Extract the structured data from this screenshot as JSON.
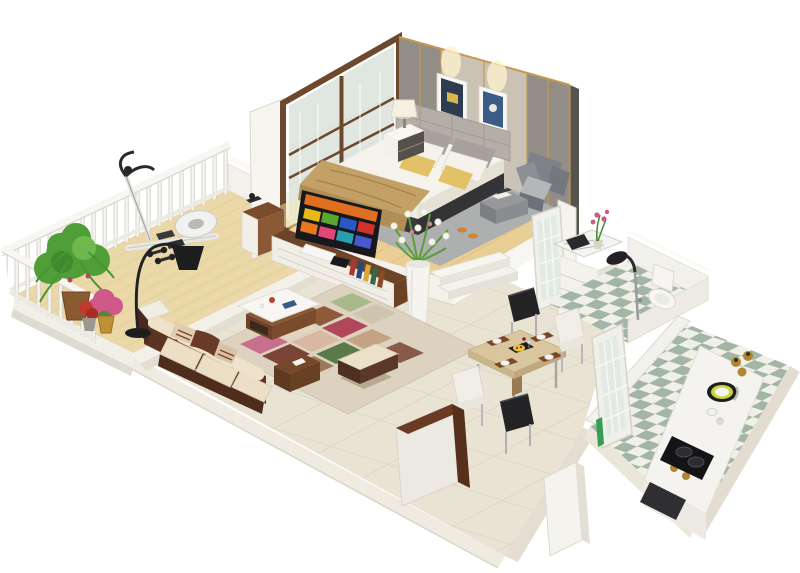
{
  "scene": {
    "description": "3D isometric cutaway render of a studio apartment floor plan",
    "rooms": [
      {
        "name": "balcony",
        "floor": "light wood planks",
        "items": [
          "white baluster railing",
          "hanging green plant",
          "pink and red potted flowers",
          "elliptical exercise trainer",
          "dumbbells"
        ]
      },
      {
        "name": "bedroom",
        "floor": "warm wood with gray rug",
        "items": [
          "double bed with white duvet",
          "tan throw blanket",
          "yellow accent pillows",
          "upholstered gray headboard",
          "two framed artworks",
          "wall spotlights",
          "sliding frosted-glass wardrobe doors",
          "white nightstand with table lamp",
          "gray armchair",
          "gray ottoman with books",
          "orange slippers"
        ]
      },
      {
        "name": "living-room",
        "floor": "large beige ceramic tiles",
        "items": [
          "dark brown sofa with cream bolster cushions",
          "patchwork rug",
          "coffee table with white top",
          "cream ottoman bench",
          "black arc floor lamp",
          "walnut and white TV media unit",
          "flat-screen smart TV with colorful app tiles",
          "tall white vase with flowers",
          "row of books"
        ]
      },
      {
        "name": "dining-area",
        "floor": "large beige ceramic tiles",
        "items": [
          "light wood dining table",
          "two black chairs",
          "two white chairs",
          "four brown place mats with white plates",
          "black serving tray with food and wine"
        ]
      },
      {
        "name": "hallway",
        "items": [
          "white frosted-glass doors",
          "marble-top vanity with pink orchid",
          "white drawer unit",
          "entrance cabinet with walnut trim",
          "cut wall stubs"
        ]
      },
      {
        "name": "bathroom",
        "floor": "green and white diamond checker tiles",
        "items": [
          "white toilet",
          "black shower head on chrome riser",
          "low white pony walls"
        ]
      },
      {
        "name": "kitchen",
        "floor": "green and white diamond checker tiles",
        "items": [
          "white galley counter",
          "round sink with lime rim",
          "black two-burner cooktop",
          "brass canisters and jars",
          "dark base cabinet"
        ]
      }
    ]
  },
  "colors": {
    "background": "#ffffff",
    "platform_top": "#efece4",
    "platform_side": "#dcd8cd",
    "tile_floor": "#e9e3d4",
    "tile_line": "#d7d0bd",
    "wood_balcony": "#ead8a8",
    "wood_bedroom": "#e9cf96",
    "wall_gray": "#928d86",
    "wall_panel": "#cac3b5",
    "wall_dark_edge": "#57534e",
    "gold_trim": "#c59a4e",
    "glass_frame": "#6e482c",
    "glass_pane": "#d8e4dc",
    "bed_white": "#f5f3ec",
    "blanket_tan": "#c3a166",
    "pillow_yellow": "#e2c167",
    "rug_gray": "#abaeb0",
    "armchair_gray": "#7e8187",
    "sofa_brown": "#5b3423",
    "cushion_cream": "#ecdfc6",
    "checker_green": "#a3b5a4",
    "checker_white": "#f1f0e8",
    "counter_white": "#f4f3ef",
    "appliance_black": "#141417",
    "brass": "#ad8733",
    "lime_ring": "#c9d43e",
    "table_wood": "#d9c69e",
    "mat_brown": "#774726",
    "chair_black": "#232326",
    "chair_white": "#f0eee7",
    "plant_green": "#4f9e38",
    "flower_pink": "#cf5888",
    "lamp_black": "#1d1d20",
    "tv_bezel": "#17181c",
    "cabinet_walnut": "#6b3a22",
    "railing_white": "#f7f6f2"
  },
  "tv_screen": {
    "banner": "#e07020",
    "tiles": [
      "#e8b818",
      "#58a830",
      "#2858c8",
      "#d03028",
      "#e87820",
      "#e04878",
      "#28a0b0",
      "#4858d0"
    ]
  }
}
